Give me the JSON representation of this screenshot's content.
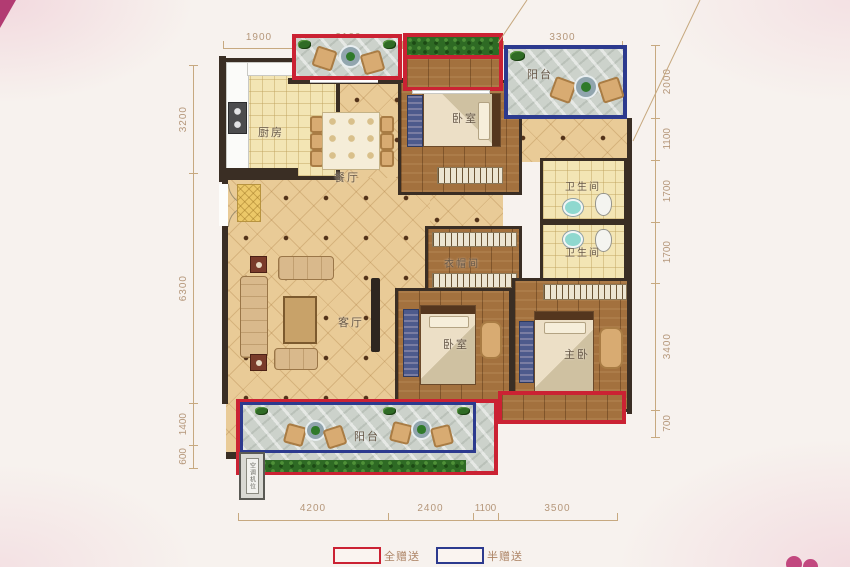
{
  "plan": {
    "rooms": {
      "kitchen": "厨房",
      "dining": "餐厅",
      "living": "客厅",
      "bedroom_top": "卧室",
      "bedroom_bottom": "卧室",
      "master_bedroom": "主卧",
      "cloakroom": "衣帽间",
      "bathroom_upper": "卫生间",
      "bathroom_lower": "卫生间",
      "balcony_top": "阳台",
      "balcony_bottom": "阳台",
      "ac_slot": "空调机位"
    }
  },
  "dimensions": {
    "top": [
      "1900",
      "3100",
      "2800",
      "3300"
    ],
    "bottom": [
      "4200",
      "2400",
      "1100",
      "3500"
    ],
    "left": [
      "3200",
      "6300",
      "1400",
      "600"
    ],
    "right": [
      "2000",
      "1100",
      "1700",
      "1700",
      "3400",
      "700"
    ]
  },
  "legend": {
    "full_gift": "全赠送",
    "half_gift": "半赠送"
  },
  "colors": {
    "full_gift_border": "#cb2233",
    "half_gift_border": "#2c3a8e",
    "wall": "#3a2e24",
    "dimension_text": "#b5977a"
  }
}
